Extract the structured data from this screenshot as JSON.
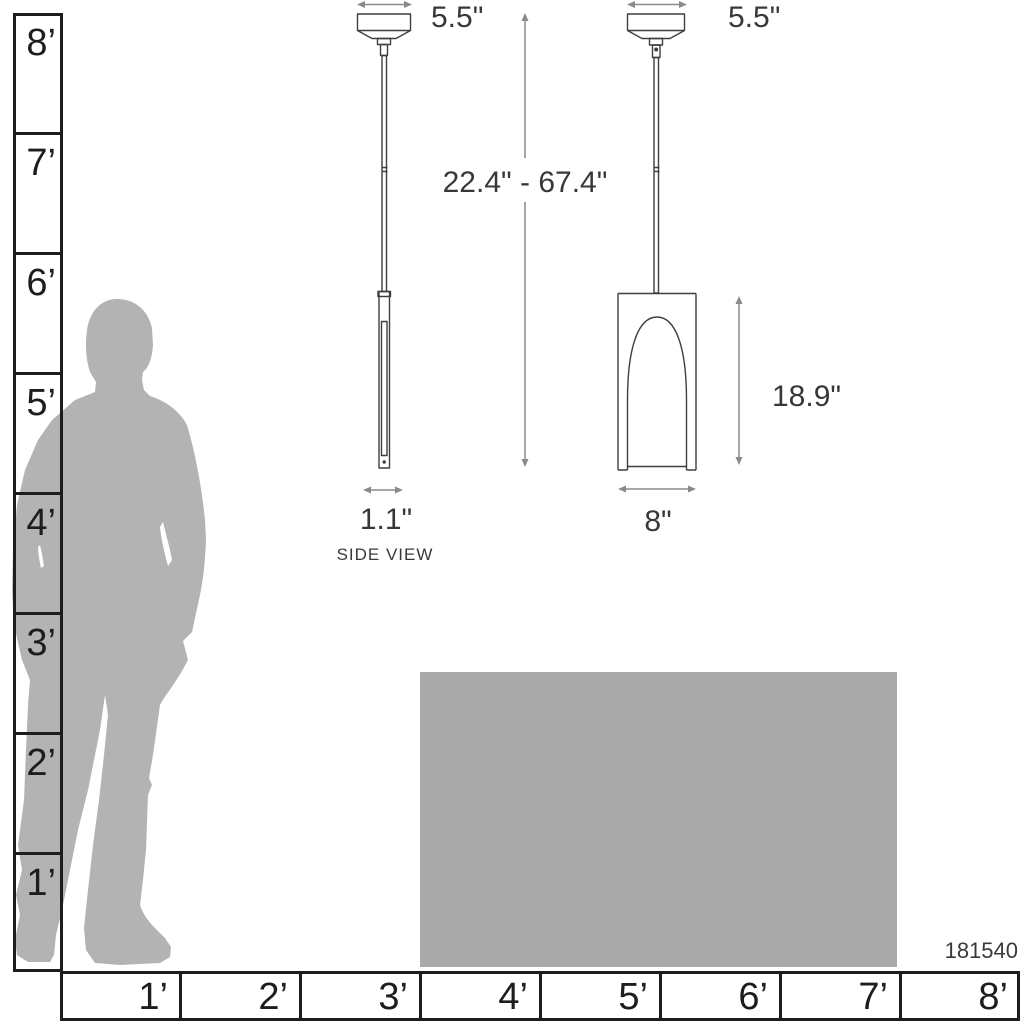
{
  "product": {
    "number": "181540"
  },
  "captions": {
    "side_view": "SIDE VIEW"
  },
  "dimensions": {
    "side_canopy_width": "5.5\"",
    "front_canopy_width": "5.5\"",
    "hanging_height_range": "22.4\" - 67.4\"",
    "shade_height": "18.9\"",
    "side_profile_width": "1.1\"",
    "shade_width": "8\""
  },
  "vertical_ruler": {
    "labels": [
      "8’",
      "7’",
      "6’",
      "5’",
      "4’",
      "3’",
      "2’",
      "1’"
    ]
  },
  "horizontal_ruler": {
    "labels": [
      "1’",
      "2’",
      "3’",
      "4’",
      "5’",
      "6’",
      "7’",
      "8’"
    ]
  },
  "colors": {
    "silhouette": "#b3b3b3",
    "table": "#a9a9a9",
    "line_art": "#3f3f3f",
    "dimension_lines": "#8a8a8a",
    "ruler_lines": "#1d1d1d",
    "background": "#ffffff"
  }
}
